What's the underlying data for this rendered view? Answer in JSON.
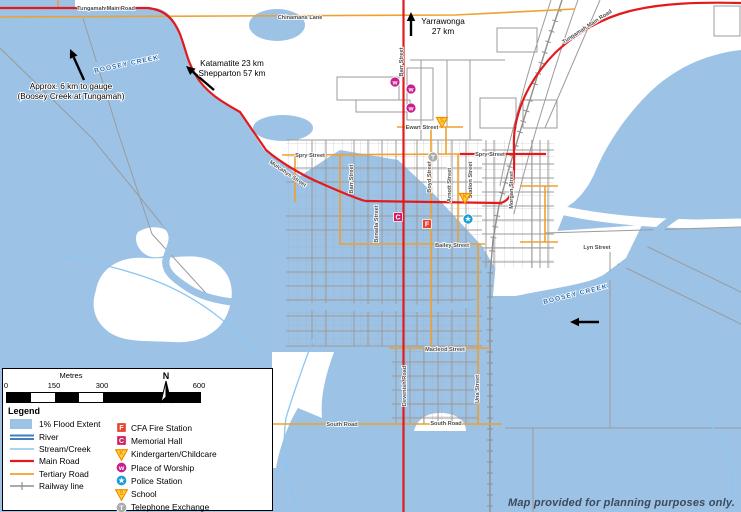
{
  "disclaimer": "Map provided for planning purposes only.",
  "colors": {
    "flood": "#9CC2E6",
    "river": "#3E7FBF",
    "river_inner": "#D3E8F8",
    "stream": "#8CC6F0",
    "main_road": "#E31A1C",
    "tertiary_road": "#EFA02F",
    "minor_road": "#A6A6A6",
    "railway": "#8F8F8F",
    "label": "#4D4D4D",
    "water_label": "#2A6CB0",
    "disclaimer": "#3D4A5C",
    "cfa": "#E8432B",
    "memorial": "#D01F63",
    "worship": "#C81F8F",
    "police": "#199CD8",
    "tri_fill": "#FFD43B",
    "tri_stroke": "#F28C00",
    "telephone": "#ACACAC"
  },
  "street_labels": [
    {
      "text": "Tungamah Main Road",
      "x": 106,
      "y": 10,
      "rot": 0
    },
    {
      "text": "Chinamans Lane",
      "x": 300,
      "y": 19,
      "rot": 0
    },
    {
      "text": "Tungamah Main Road",
      "x": 588,
      "y": 28,
      "rot": -33
    },
    {
      "text": "Barr Street",
      "x": 403,
      "y": 62,
      "rot": -90
    },
    {
      "text": "Spry Street",
      "x": 310,
      "y": 157,
      "rot": 0
    },
    {
      "text": "Spry Street",
      "x": 490,
      "y": 156,
      "rot": 0
    },
    {
      "text": "Mulcahys Street",
      "x": 287,
      "y": 175,
      "rot": 34
    },
    {
      "text": "Barr Street",
      "x": 353,
      "y": 179,
      "rot": -90
    },
    {
      "text": "Benalla Street",
      "x": 378,
      "y": 224,
      "rot": -90
    },
    {
      "text": "Boyd Street",
      "x": 431,
      "y": 177,
      "rot": -90
    },
    {
      "text": "Arnott Street",
      "x": 451,
      "y": 185,
      "rot": -90
    },
    {
      "text": "Station Street",
      "x": 472,
      "y": 180,
      "rot": -90
    },
    {
      "text": "Morgan Street",
      "x": 513,
      "y": 190,
      "rot": -90
    },
    {
      "text": "Ewart Street",
      "x": 422,
      "y": 129,
      "rot": 0
    },
    {
      "text": "Bailey Street",
      "x": 452,
      "y": 247,
      "rot": 0
    },
    {
      "text": "Macleod Street",
      "x": 445,
      "y": 351,
      "rot": 0
    },
    {
      "text": "Devenish Road",
      "x": 406,
      "y": 386,
      "rot": -90
    },
    {
      "text": "South Road",
      "x": 342,
      "y": 426,
      "rot": 0
    },
    {
      "text": "South Road",
      "x": 446,
      "y": 425,
      "rot": 0
    },
    {
      "text": "Lyn Street",
      "x": 597,
      "y": 249,
      "rot": 0
    },
    {
      "text": "Una Street",
      "x": 479,
      "y": 389,
      "rot": -90
    }
  ],
  "water_labels": [
    {
      "text": "BOOSEY CREEK",
      "x": 127,
      "y": 66,
      "rot": -12
    },
    {
      "text": "BOOSEY CREEK",
      "x": 576,
      "y": 296,
      "rot": -14
    }
  ],
  "annotations": [
    {
      "id": "gauge-note",
      "lines": [
        "Approx. 6 km to gauge",
        "(Boosey Creek at Tungamah)"
      ],
      "x": 71,
      "y": 89
    },
    {
      "id": "katamatite-note",
      "lines": [
        "Katamatite 23 km",
        "Shepparton 57 km"
      ],
      "x": 232,
      "y": 66
    },
    {
      "id": "yarrawonga-note",
      "lines": [
        "Yarrawonga",
        "27 km"
      ],
      "x": 443,
      "y": 24
    }
  ],
  "arrows": [
    {
      "x1": 84,
      "y1": 80,
      "x2": 70,
      "y2": 49
    },
    {
      "x1": 214,
      "y1": 90,
      "x2": 186,
      "y2": 66
    },
    {
      "x1": 411,
      "y1": 36,
      "x2": 411,
      "y2": 12
    },
    {
      "x1": 599,
      "y1": 322,
      "x2": 570,
      "y2": 322
    }
  ],
  "poi_on_map": [
    {
      "type": "worship",
      "x": 395,
      "y": 82
    },
    {
      "type": "worship",
      "x": 411,
      "y": 89
    },
    {
      "type": "worship",
      "x": 411,
      "y": 108
    },
    {
      "type": "school",
      "x": 442,
      "y": 122
    },
    {
      "type": "telephone",
      "x": 433,
      "y": 157
    },
    {
      "type": "kindergarten",
      "x": 465,
      "y": 198
    },
    {
      "type": "police",
      "x": 468,
      "y": 219
    },
    {
      "type": "memorial",
      "x": 398,
      "y": 217
    },
    {
      "type": "cfa",
      "x": 427,
      "y": 224
    }
  ],
  "legend": {
    "title": "Legend",
    "north_label": "N",
    "scale": {
      "unit_label": "Metres",
      "ticks": [
        "0",
        "150",
        "300",
        "600"
      ]
    },
    "flood_items": [
      {
        "label": "1% Flood Extent",
        "swatch": "flood"
      },
      {
        "label": "River",
        "swatch": "river"
      },
      {
        "label": "Stream/Creek",
        "swatch": "stream"
      },
      {
        "label": "Main Road",
        "swatch": "main-road"
      },
      {
        "label": "Tertiary Road",
        "swatch": "tertiary-road"
      },
      {
        "label": "Railway line",
        "swatch": "railway"
      }
    ],
    "poi_items": [
      {
        "label": "CFA Fire Station",
        "icon": "cfa"
      },
      {
        "label": "Memorial Hall",
        "icon": "memorial"
      },
      {
        "label": "Kindergarten/Childcare",
        "icon": "kindergarten"
      },
      {
        "label": "Place of Worship",
        "icon": "worship"
      },
      {
        "label": "Police Station",
        "icon": "police"
      },
      {
        "label": "School",
        "icon": "school"
      },
      {
        "label": "Telephone Exchange",
        "icon": "telephone"
      }
    ]
  }
}
